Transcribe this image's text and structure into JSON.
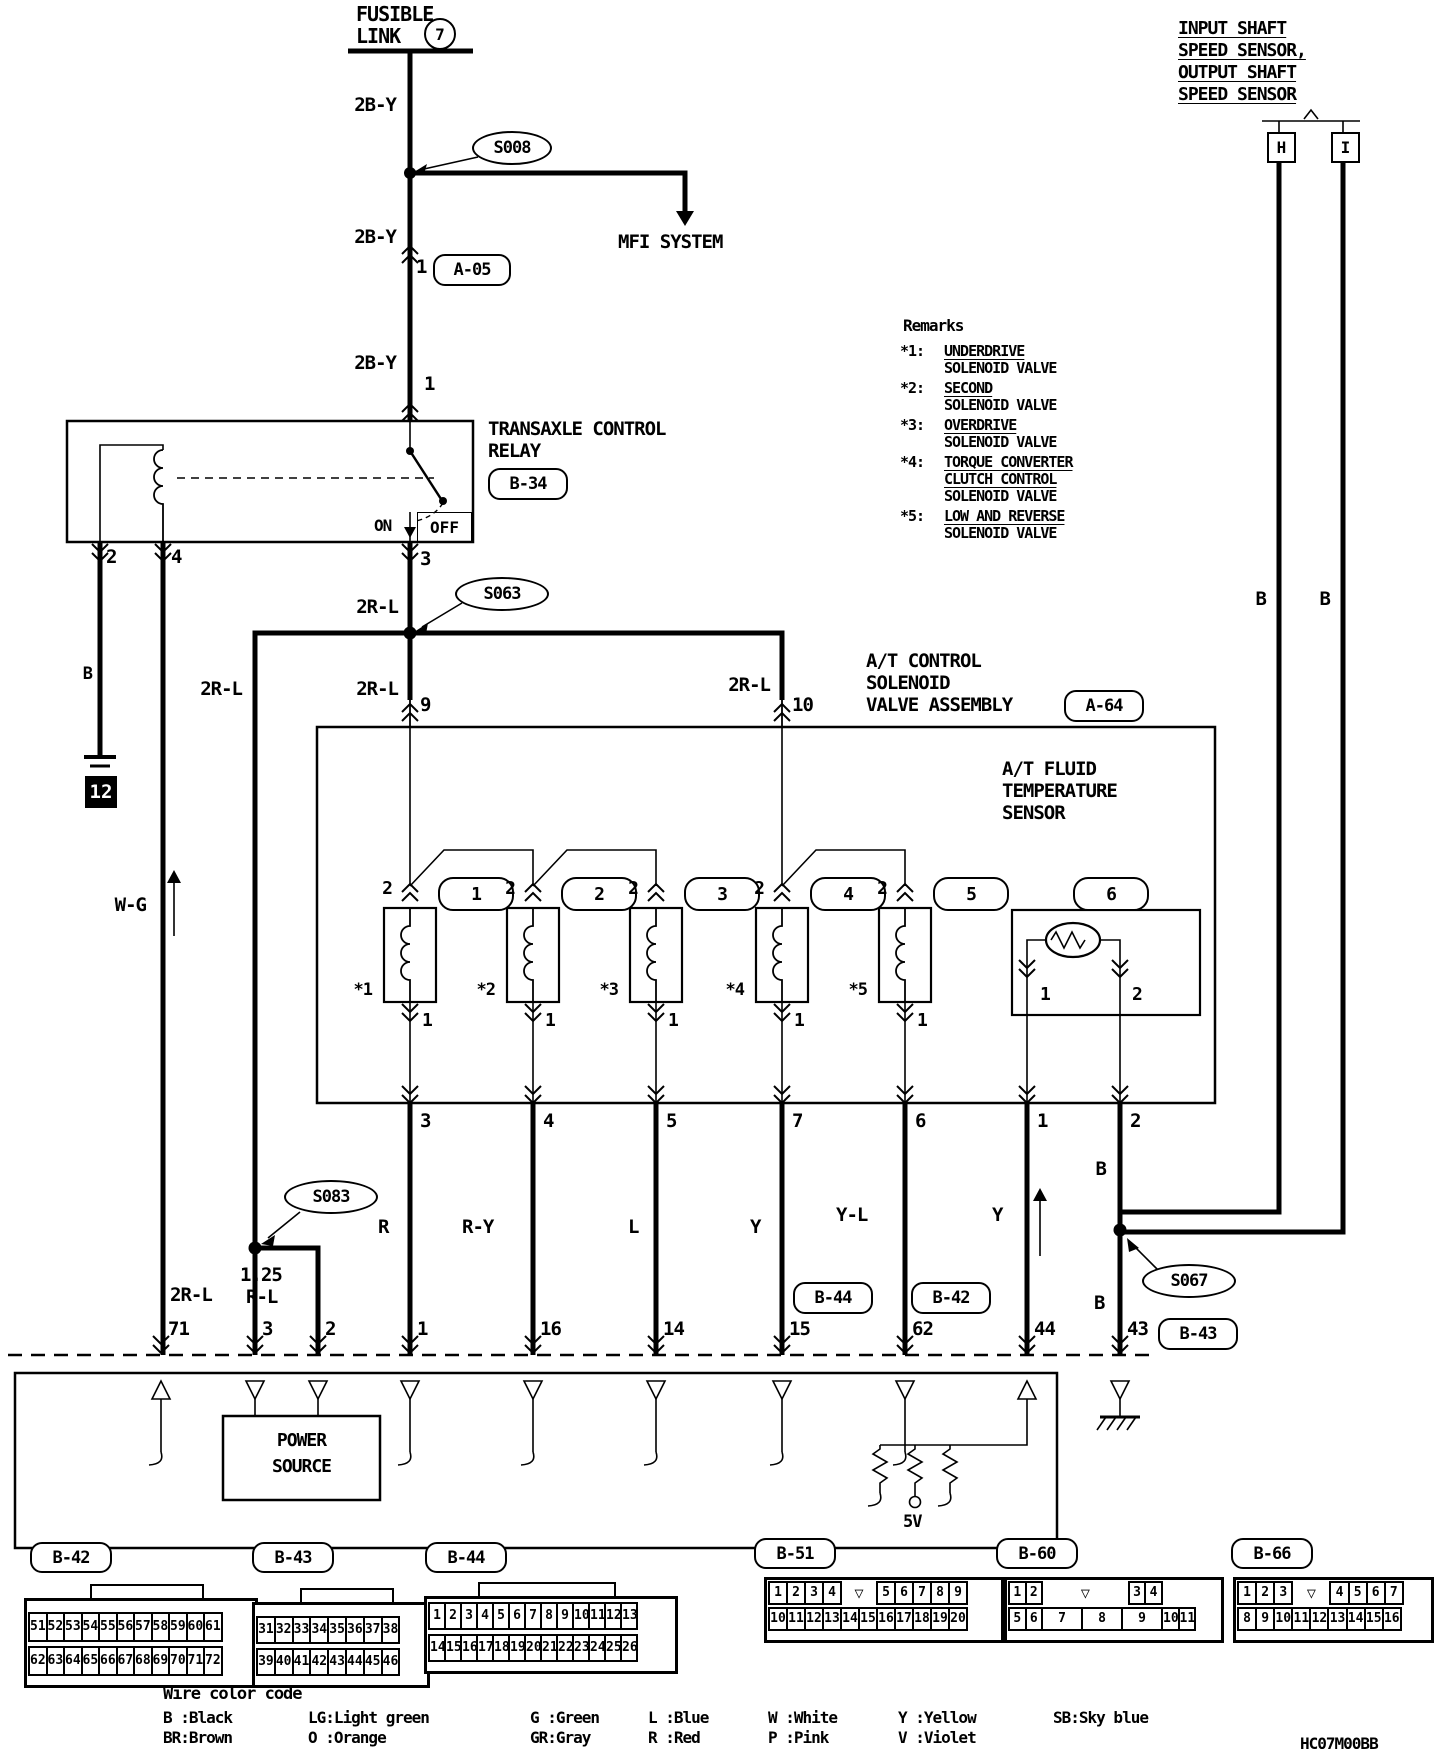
{
  "colors": {
    "ink": "#000000",
    "paper": "#ffffff"
  },
  "icons": {
    "keyway": "▽",
    "ground_box": "black-square-numbered"
  },
  "doc_code": "HC07M00BB",
  "fusible_link": {
    "line1": "FUSIBLE",
    "line2": "LINK",
    "fuse": "7"
  },
  "top": {
    "mfi": "MFI SYSTEM",
    "a05_pin": "1",
    "a05": "A-05",
    "relay_pin": "1"
  },
  "wires": {
    "by": "2B-Y",
    "rl": "2R-L",
    "rl125a": "1.25",
    "rl125b": "R-L",
    "b": "B",
    "wg": "W-G"
  },
  "splices": {
    "s1": "S008",
    "s2": "S063",
    "s3": "S083",
    "s4": "S067"
  },
  "relay": {
    "name1": "TRANSAXLE CONTROL",
    "name2": "RELAY",
    "ref": "B-34",
    "on": "ON",
    "off": "OFF",
    "pin2": "2",
    "pin4": "4",
    "pin3": "3"
  },
  "grounds": {
    "num": "12"
  },
  "remarks": {
    "title": "Remarks",
    "items": [
      {
        "key": "*1:",
        "lines": [
          "UNDERDRIVE",
          "SOLENOID VALVE"
        ]
      },
      {
        "key": "*2:",
        "lines": [
          "SECOND",
          "SOLENOID VALVE"
        ]
      },
      {
        "key": "*3:",
        "lines": [
          "OVERDRIVE",
          "SOLENOID VALVE"
        ]
      },
      {
        "key": "*4:",
        "lines": [
          "TORQUE CONVERTER",
          "CLUTCH CONTROL",
          "SOLENOID VALVE"
        ]
      },
      {
        "key": "*5:",
        "lines": [
          "LOW AND REVERSE",
          "SOLENOID VALVE"
        ]
      }
    ]
  },
  "assembly": {
    "title1": "A/T CONTROL",
    "title2": "SOLENOID",
    "title3": "VALVE ASSEMBLY",
    "ref": "A-64",
    "pin9": "9",
    "pin10": "10",
    "sensor": {
      "t1": "A/T FLUID",
      "t2": "TEMPERATURE",
      "t3": "SENSOR",
      "pin1": "1",
      "pin2": "2"
    },
    "solenoids": [
      {
        "badge": "1",
        "top_pin": "2",
        "bottom_pin": "1",
        "star": "*1"
      },
      {
        "badge": "2",
        "top_pin": "2",
        "bottom_pin": "1",
        "star": "*2"
      },
      {
        "badge": "3",
        "top_pin": "2",
        "bottom_pin": "1",
        "star": "*3"
      },
      {
        "badge": "4",
        "top_pin": "2",
        "bottom_pin": "1",
        "star": "*4"
      },
      {
        "badge": "5",
        "top_pin": "2",
        "bottom_pin": "1",
        "star": "*5"
      }
    ],
    "badge6": "6",
    "bottom_pins": [
      "3",
      "4",
      "5",
      "7",
      "6",
      "1",
      "2"
    ]
  },
  "wire_labels": {
    "items": [
      "R",
      "R-Y",
      "L",
      "Y",
      "Y-L",
      "Y"
    ]
  },
  "sensors": {
    "l1": "INPUT SHAFT",
    "l2": "SPEED SENSOR,",
    "l3": "OUTPUT SHAFT",
    "l4": "SPEED SENSOR",
    "h": "H",
    "i": "I"
  },
  "ecu": {
    "pins": [
      "71",
      "3",
      "2",
      "1",
      "16",
      "14",
      "15",
      "62",
      "44",
      "43"
    ],
    "power1": "POWER",
    "power2": "SOURCE",
    "v5": "5V",
    "refs": {
      "b44": "B-44",
      "b42": "B-42",
      "b43": "B-43"
    }
  },
  "connectors": [
    {
      "ref": "B-42",
      "rows": [
        [
          "51",
          "52",
          "53",
          "54",
          "55",
          "56",
          "57",
          "58",
          "59",
          "60",
          "61"
        ],
        [
          "62",
          "63",
          "64",
          "65",
          "66",
          "67",
          "68",
          "69",
          "70",
          "71",
          "72"
        ]
      ]
    },
    {
      "ref": "B-43",
      "rows": [
        [
          "31",
          "32",
          "33",
          "34",
          "35",
          "36",
          "37",
          "38"
        ],
        [
          "39",
          "40",
          "41",
          "42",
          "43",
          "44",
          "45",
          "46"
        ]
      ]
    },
    {
      "ref": "B-44",
      "rows": [
        [
          "1",
          "2",
          "3",
          "4",
          "5",
          "6",
          "7",
          "8",
          "9",
          "10",
          "11",
          "12",
          "13"
        ],
        [
          "14",
          "15",
          "16",
          "17",
          "18",
          "19",
          "20",
          "21",
          "22",
          "23",
          "24",
          "25",
          "26"
        ]
      ]
    },
    {
      "ref": "B-51",
      "rows": [
        [
          "1",
          "2",
          "3",
          "4",
          {
            "key": true,
            "w": 1.9
          },
          "5",
          "6",
          "7",
          "8",
          "9"
        ],
        [
          "10",
          "11",
          "12",
          "13",
          "14",
          "15",
          "16",
          "17",
          "18",
          "19",
          "20"
        ]
      ]
    },
    {
      "ref": "B-60",
      "rows": [
        [
          "1",
          "2",
          {
            "key": true,
            "w": 4.8
          },
          "3",
          "4"
        ],
        [
          "5",
          "6",
          {
            "t": "7",
            "w": 2.27
          },
          {
            "t": "8",
            "w": 2.27
          },
          {
            "t": "9",
            "w": 2.27
          },
          "10",
          "11"
        ]
      ]
    },
    {
      "ref": "B-66",
      "rows": [
        [
          "1",
          "2",
          "3",
          {
            "key": true,
            "w": 2
          },
          "4",
          "5",
          "6",
          "7"
        ],
        [
          "8",
          "9",
          "10",
          "11",
          "12",
          "13",
          "14",
          "15",
          "16"
        ]
      ]
    }
  ],
  "color_code": {
    "title": "Wire color code",
    "row1": [
      "B :Black",
      "LG:Light green",
      "G :Green",
      "L :Blue",
      "W :White",
      "Y :Yellow",
      "SB:Sky blue"
    ],
    "row2": [
      "BR:Brown",
      "O :Orange",
      "GR:Gray",
      "R :Red",
      "P :Pink",
      "V :Violet"
    ]
  }
}
